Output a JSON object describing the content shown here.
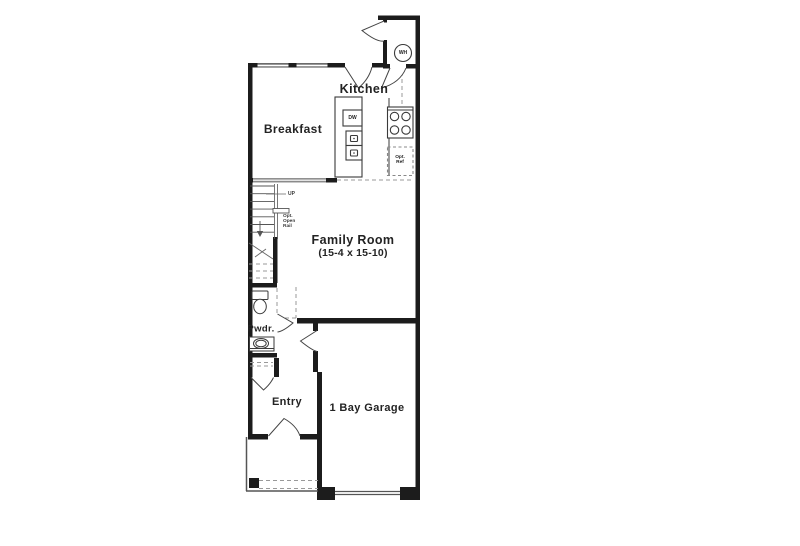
{
  "plan": {
    "rooms": {
      "kitchen": "Kitchen",
      "breakfast": "Breakfast",
      "family_room": "Family Room",
      "family_room_dims": "(15-4 x 15-10)",
      "powder": "Pwdr.",
      "entry": "Entry",
      "garage": "1 Bay Garage"
    },
    "annotations": {
      "water_heater": "WH",
      "dishwasher": "DW",
      "up": "UP",
      "opt_open_rail": [
        "Opt.",
        "Open",
        "Rail"
      ],
      "opt_ref": [
        "Opt.",
        "Ref"
      ]
    },
    "colors": {
      "wall": "#1c1c1c",
      "background": "#ffffff",
      "dashed_line": "#999999",
      "thin_line": "#444444"
    }
  }
}
